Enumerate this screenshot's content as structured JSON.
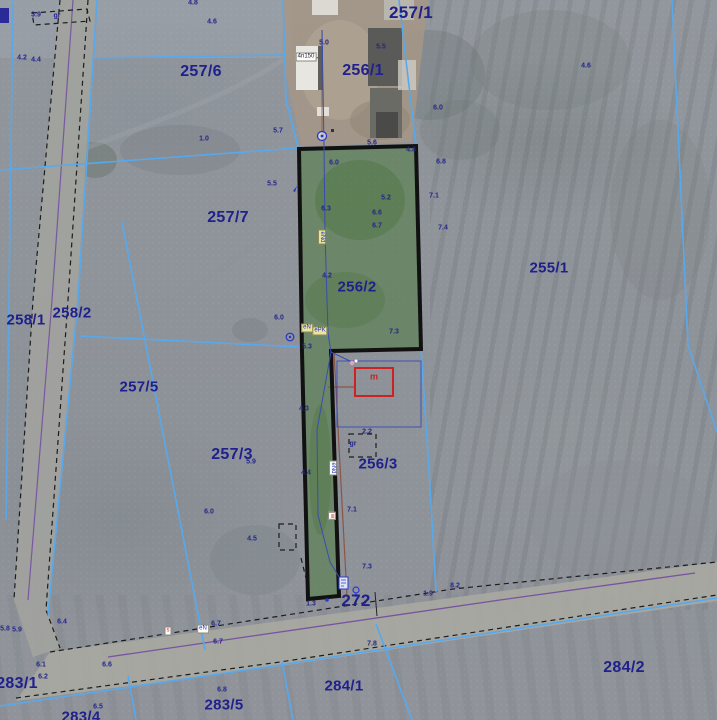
{
  "map_title": "Cadastral aerial map",
  "colors": {
    "parcel_line": "#57a9ee",
    "parcel_label": "#20208c",
    "highlight_fill": "#4e7a3f",
    "highlight_border": "#111111",
    "building_outline_red": "#cc2222",
    "road_dash": "#1c1c1c",
    "utility_purple": "#6b3fa0",
    "utility_red_brown": "#8a4a3a",
    "utility_blue": "#3a4db0"
  },
  "parcel_labels": [
    {
      "label": "257/1",
      "x": 411,
      "y": 13,
      "size": 17
    },
    {
      "label": "257/6",
      "x": 201,
      "y": 72,
      "size": 16
    },
    {
      "label": "256/1",
      "x": 363,
      "y": 71,
      "size": 16
    },
    {
      "label": "257/7",
      "x": 228,
      "y": 218,
      "size": 16
    },
    {
      "label": "255/1",
      "x": 549,
      "y": 268,
      "size": 15
    },
    {
      "label": "256/2",
      "x": 357,
      "y": 287,
      "size": 15
    },
    {
      "label": "258/1",
      "x": 26,
      "y": 320,
      "size": 15
    },
    {
      "label": "258/2",
      "x": 72,
      "y": 313,
      "size": 15
    },
    {
      "label": "257/5",
      "x": 139,
      "y": 387,
      "size": 15
    },
    {
      "label": "257/3",
      "x": 232,
      "y": 455,
      "size": 16
    },
    {
      "label": "256/3",
      "x": 378,
      "y": 464,
      "size": 15
    },
    {
      "label": "272",
      "x": 356,
      "y": 601,
      "size": 17
    },
    {
      "label": "283/1",
      "x": 17,
      "y": 684,
      "size": 16
    },
    {
      "label": "284/1",
      "x": 344,
      "y": 686,
      "size": 15
    },
    {
      "label": "284/2",
      "x": 624,
      "y": 668,
      "size": 16
    },
    {
      "label": "283/5",
      "x": 224,
      "y": 705,
      "size": 15
    },
    {
      "label": "283/4",
      "x": 81,
      "y": 717,
      "size": 15
    }
  ],
  "measurements": [
    {
      "v": "3.9",
      "x": 36,
      "y": 15
    },
    {
      "v": "gr",
      "x": 57,
      "y": 16
    },
    {
      "v": "4.8",
      "x": 193,
      "y": 3
    },
    {
      "v": "4.6",
      "x": 212,
      "y": 22
    },
    {
      "v": "4.2",
      "x": 22,
      "y": 58
    },
    {
      "v": "4.4",
      "x": 36,
      "y": 60
    },
    {
      "v": "4.6",
      "x": 586,
      "y": 66
    },
    {
      "v": "5.0",
      "x": 324,
      "y": 43
    },
    {
      "v": "5.5",
      "x": 381,
      "y": 47
    },
    {
      "v": "5.6",
      "x": 372,
      "y": 143
    },
    {
      "v": "6.0",
      "x": 438,
      "y": 108
    },
    {
      "v": "5.7",
      "x": 278,
      "y": 131
    },
    {
      "v": "1.0",
      "x": 204,
      "y": 139
    },
    {
      "v": "4.8",
      "x": 411,
      "y": 150
    },
    {
      "v": "6.0",
      "x": 334,
      "y": 163
    },
    {
      "v": "5.5",
      "x": 272,
      "y": 184
    },
    {
      "v": "5.2",
      "x": 386,
      "y": 198
    },
    {
      "v": "7.1",
      "x": 434,
      "y": 196
    },
    {
      "v": "6.3",
      "x": 326,
      "y": 209
    },
    {
      "v": "6.6",
      "x": 377,
      "y": 213
    },
    {
      "v": "6.7",
      "x": 377,
      "y": 226
    },
    {
      "v": "7.4",
      "x": 443,
      "y": 228
    },
    {
      "v": "6.8",
      "x": 441,
      "y": 162
    },
    {
      "v": "4.2",
      "x": 327,
      "y": 276
    },
    {
      "v": "6.0",
      "x": 279,
      "y": 318
    },
    {
      "v": "5.3",
      "x": 307,
      "y": 347
    },
    {
      "v": "7.3",
      "x": 394,
      "y": 332
    },
    {
      "v": "2.2",
      "x": 367,
      "y": 432
    },
    {
      "v": "gr",
      "x": 353,
      "y": 444
    },
    {
      "v": "7.1",
      "x": 352,
      "y": 510
    },
    {
      "v": "5.9",
      "x": 251,
      "y": 462
    },
    {
      "v": "6.0",
      "x": 209,
      "y": 512
    },
    {
      "v": "4.5",
      "x": 252,
      "y": 539
    },
    {
      "v": "4.3",
      "x": 304,
      "y": 409
    },
    {
      "v": "4.4",
      "x": 306,
      "y": 473
    },
    {
      "v": "7.3",
      "x": 367,
      "y": 567
    },
    {
      "v": "7.8",
      "x": 372,
      "y": 644
    },
    {
      "v": "8.2",
      "x": 455,
      "y": 586
    },
    {
      "v": "1.9",
      "x": 428,
      "y": 594
    },
    {
      "v": "1.3",
      "x": 311,
      "y": 604
    },
    {
      "v": "6.4",
      "x": 62,
      "y": 622
    },
    {
      "v": "5.8",
      "x": 5,
      "y": 629
    },
    {
      "v": "5.9",
      "x": 17,
      "y": 630
    },
    {
      "v": "6.7",
      "x": 216,
      "y": 624
    },
    {
      "v": "6.7",
      "x": 218,
      "y": 642
    },
    {
      "v": "6.1",
      "x": 41,
      "y": 665
    },
    {
      "v": "6.6",
      "x": 107,
      "y": 665
    },
    {
      "v": "6.2",
      "x": 43,
      "y": 677
    },
    {
      "v": "6.5",
      "x": 98,
      "y": 707
    },
    {
      "v": "6.8",
      "x": 222,
      "y": 690
    }
  ],
  "annotations": [
    {
      "t": "4n150",
      "x": 306,
      "y": 57,
      "cls": "box"
    },
    {
      "t": "eNd",
      "x": 322,
      "y": 237,
      "cls": "box yellow vert blue-text"
    },
    {
      "t": "eN",
      "x": 307,
      "y": 328,
      "cls": "box yellow blue-text"
    },
    {
      "t": "ePK",
      "x": 320,
      "y": 331,
      "cls": "box yellow blue-text"
    },
    {
      "t": "eNd",
      "x": 333,
      "y": 468,
      "cls": "box vert blue-text"
    },
    {
      "t": "w",
      "x": 332,
      "y": 516,
      "cls": "box vert red-text"
    },
    {
      "t": "s",
      "x": 168,
      "y": 631,
      "cls": "box red-text"
    },
    {
      "t": "eN",
      "x": 203,
      "y": 629,
      "cls": "box blue-text"
    },
    {
      "t": "m",
      "x": 374,
      "y": 377,
      "cls": "plain red-text"
    }
  ]
}
